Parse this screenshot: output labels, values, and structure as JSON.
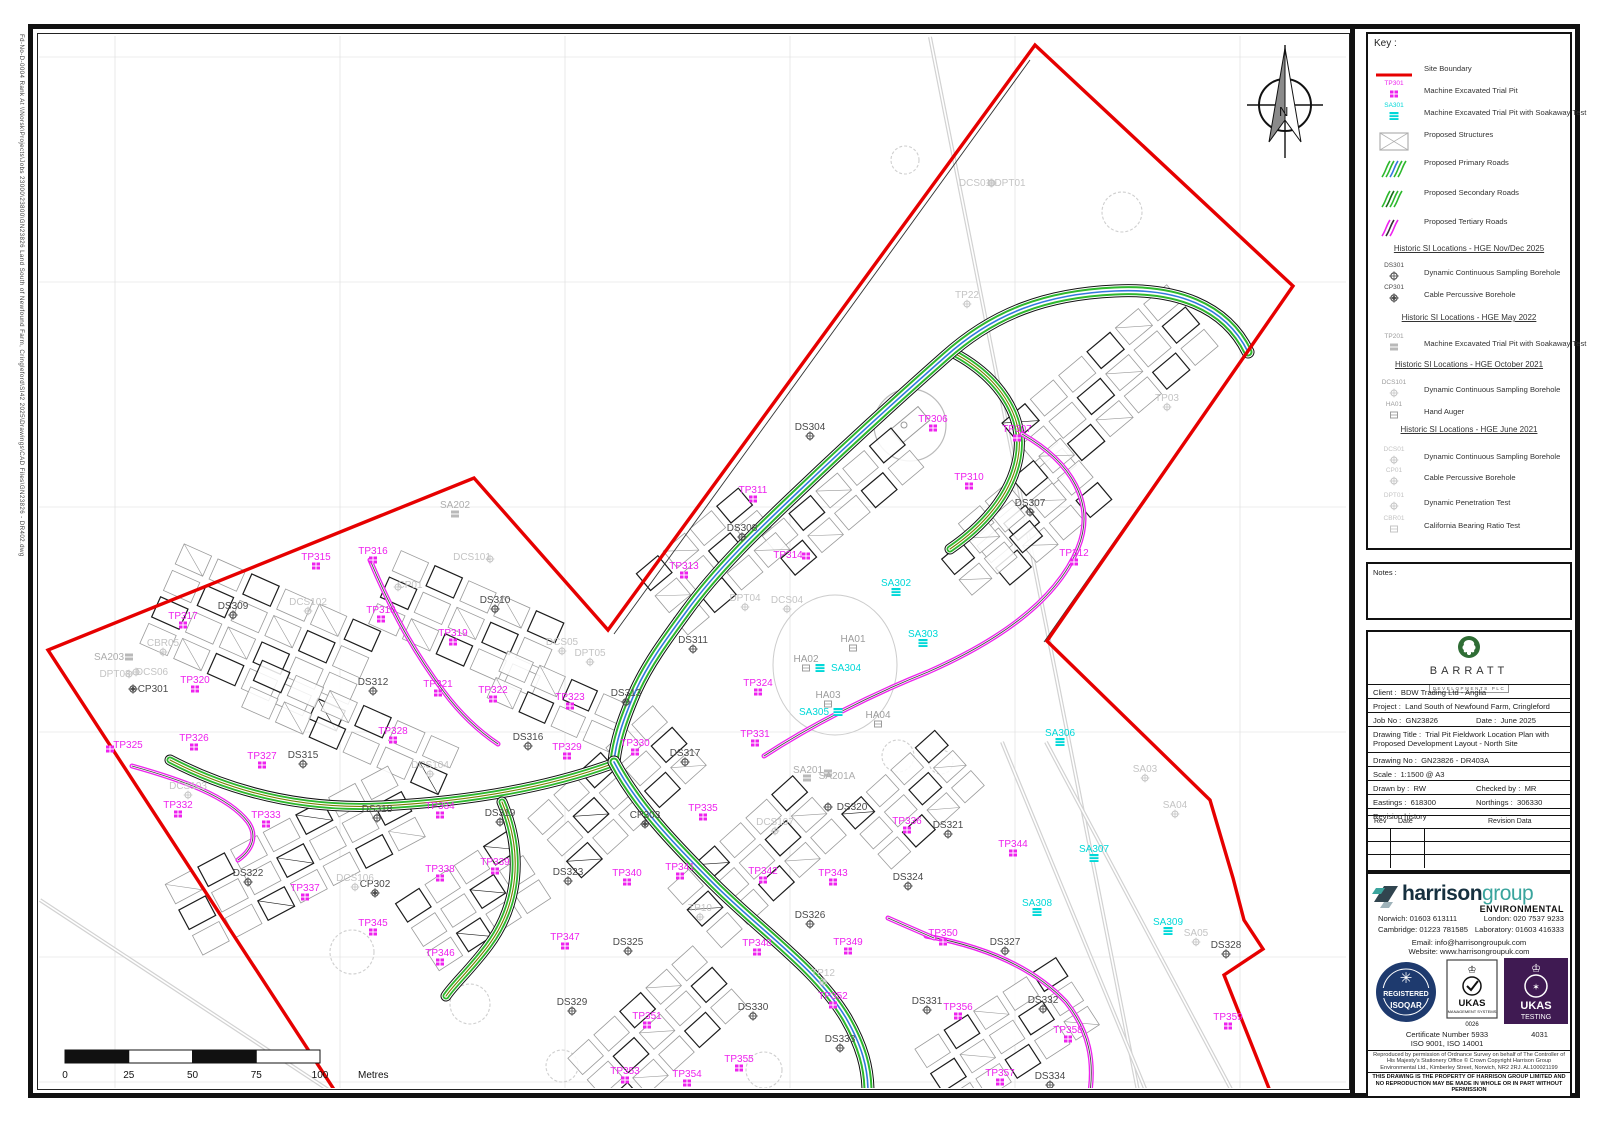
{
  "colors": {
    "red": "#e60000",
    "magenta": "#ee22ee",
    "cyan": "#00d8d8",
    "green": "#2db82d",
    "blue": "#3377dd",
    "olive": "#7a7a00",
    "dark": "#4a4a4a",
    "gray": "#9c9c9c",
    "lightgray": "#c4c4c4",
    "navy": "#1e3a6e",
    "purple": "#3f1a52",
    "barratt_green": "#2f6d35"
  },
  "edge_note": "Fd-No-D-0004  Rank At  \\\\Norsk\\Projects\\Jobs 23000\\23800\\GN23826  Land South of Newfound Farm, Cringleford\\SI42 2025\\Drawings\\CAD Files\\GN23826 - DR402.dwg",
  "north_label": "N",
  "key": {
    "title": "Key :",
    "items": [
      {
        "y": 27,
        "icon": "redline",
        "text": "Site Boundary"
      },
      {
        "y": 49,
        "icon": "tp",
        "code": "TP301",
        "text": "Machine Excavated Trial Pit"
      },
      {
        "y": 71,
        "icon": "sa",
        "code": "SA301",
        "text": "Machine Excavated Trial Pit with Soakaway Test"
      },
      {
        "y": 93,
        "icon": "struct",
        "text": "Proposed Structures"
      },
      {
        "y": 121,
        "icon": "prim",
        "text": "Proposed Primary Roads"
      },
      {
        "y": 151,
        "icon": "sec",
        "text": "Proposed Secondary Roads"
      },
      {
        "y": 180,
        "icon": "tert",
        "text": "Proposed Tertiary Roads"
      },
      {
        "y": 210,
        "header": "Historic SI Locations - HGE Nov/Dec 2025"
      },
      {
        "y": 231,
        "icon": "ds",
        "code": "DS301",
        "text": "Dynamic Continuous Sampling Borehole"
      },
      {
        "y": 253,
        "icon": "cp",
        "code": "CP301",
        "text": "Cable Percussive Borehole"
      },
      {
        "y": 279,
        "header": "Historic SI Locations - HGE May 2022"
      },
      {
        "y": 302,
        "icon": "gs",
        "code": "TP201",
        "text": "Machine Excavated Trial Pit with Soakaway Test"
      },
      {
        "y": 326,
        "header": "Historic SI Locations - HGE October 2021"
      },
      {
        "y": 348,
        "icon": "gh",
        "code": "DCS101",
        "text": "Dynamic Continuous Sampling Borehole"
      },
      {
        "y": 370,
        "icon": "ha",
        "code": "HA01",
        "text": "Hand Auger"
      },
      {
        "y": 391,
        "header": "Historic SI Locations - HGE June 2021"
      },
      {
        "y": 415,
        "icon": "lh",
        "code": "DCS01",
        "text": "Dynamic Continuous Sampling Borehole"
      },
      {
        "y": 436,
        "icon": "lh",
        "code": "CP01",
        "text": "Cable Percussive Borehole"
      },
      {
        "y": 461,
        "icon": "lh",
        "code": "DPT01",
        "text": "Dynamic Penetration Test"
      },
      {
        "y": 484,
        "icon": "lb",
        "code": "CBR01",
        "text": "California Bearing Ratio Test"
      }
    ]
  },
  "notes_label": "Notes :",
  "title_block": {
    "brand_name": "BARRATT",
    "brand_sub": "DEVELOPMENTS PLC",
    "client_label": "Client :",
    "client_value": "BDW Trading Ltd - Anglia",
    "project_label": "Project :",
    "project_value": "Land South of Newfound Farm, Cringleford",
    "job_label": "Job No :",
    "job_value": "GN23826",
    "date_label": "Date :",
    "date_value": "June 2025",
    "drawing_title_label": "Drawing Title :",
    "drawing_title_value": "Trial Pit Fieldwork Location Plan with Proposed Development Layout - North Site",
    "drawing_no_label": "Drawing No :",
    "drawing_no_value": "GN23826 - DR403A",
    "scale_label": "Scale :",
    "scale_value": "1:1500 @ A3",
    "drawn_label": "Drawn by :",
    "drawn_value": "RW",
    "checked_label": "Checked by :",
    "checked_value": "MR",
    "eastings_label": "Eastings :",
    "eastings_value": "618300",
    "northings_label": "Northings :",
    "northings_value": "306330",
    "revision_label": "Revision history",
    "rev_cols": [
      "Rev",
      "Date",
      "Revision Data"
    ]
  },
  "harrison": {
    "word1": "harrison",
    "word2": "group",
    "env": "ENVIRONMENTAL",
    "contact_norwich": "Norwich: 01603 613111",
    "contact_london": "London: 020 7537 9233",
    "contact_cambridge": "Cambridge: 01223 781585",
    "contact_lab": "Laboratory: 01603 416333",
    "email": "Email: info@harrisongroupuk.com",
    "website": "Website: www.harrisongroupuk.com",
    "badge_registered": "REGISTERED",
    "badge_isoqar": "ISOQAR",
    "badge_ukas1": "UKAS",
    "badge_mgmt": "MANAGEMENT SYSTEMS",
    "badge_0026": "0026",
    "badge_ukas2": "UKAS",
    "badge_testing": "TESTING",
    "cert1": "Certificate Number 5933",
    "cert2": "ISO 9001, ISO 14001",
    "testing_no": "4031",
    "os_copyright": "Reproduced by permission of Ordnance Survey on behalf of The Controller of His Majesty's Stationery Office © Crown Copyright Harrison Group Environmental Ltd., Kimberley Street, Norwich, NR2 2RJ. AL100021199",
    "property_note": "THIS DRAWING IS THE PROPERTY OF HARRISON GROUP LIMITED AND NO REPRODUCTION MAY BE MADE IN WHOLE OR IN PART WITHOUT PERMISSION"
  },
  "scalebar": {
    "ticks": [
      "0",
      "25",
      "50",
      "75",
      "100"
    ],
    "unit": "Metres",
    "x0": 65,
    "x1": 320,
    "y": 1050
  },
  "map": {
    "grid_x": [
      115,
      340,
      565,
      790,
      1015,
      1240
    ],
    "grid_y": [
      57,
      282,
      507,
      732,
      957,
      1082
    ],
    "boundary": "M 335,1091 L 48,650 L 474,478 L 608,630 L 1035,45 L 1293,286 L 1047,641 L 1210,800 L 1233,878 L 1244,920 L 1263,949 L 1224,975 L 1270,1091",
    "boundary_offsets": [
      "M 614,634 L 1030,60",
      "M 1286,296 L 1044,642"
    ],
    "footpaths": [
      "M 930,37 L 1138,1091",
      "M 1002,742 L 1146,1091",
      "M 1046,742 L 1232,1091",
      "M 40,900 L 330,1091"
    ],
    "primary_roads": [
      "M 1248,352 C 1225,305 1175,288 1115,291 C 1048,294 995,312 945,357 C 893,403 845,447 798,492 C 758,530 718,568 686,612 C 664,642 648,664 636,690 C 622,722 616,742 614,762",
      "M 614,762 C 636,804 672,842 714,884 C 762,932 816,968 846,1018 C 862,1046 868,1068 868,1092"
    ],
    "secondary_roads": [
      "M 952,352 C 998,376 1026,416 1018,458 C 1011,496 982,527 950,549",
      "M 612,764 C 540,790 460,802 380,806 C 290,810 220,786 170,760",
      "M 502,802 C 524,854 518,906 488,946 C 470,970 454,984 446,996"
    ],
    "tertiary_roads": [
      "M 370,560 C 392,612 414,652 444,692 C 462,716 480,732 498,744",
      "M 132,766 C 182,780 228,796 248,822 C 258,836 252,850 238,860",
      "M 1022,434 C 1072,462 1096,504 1078,548 C 1056,602 996,642 928,672 C 868,696 810,726 764,756",
      "M 926,936 C 982,946 1032,966 1066,1002 C 1090,1032 1094,1062 1090,1092",
      "M 888,918 C 906,926 920,932 934,938"
    ],
    "clusters": [
      [
        1115,
        385,
        6,
        3,
        30,
        22,
        -40
      ],
      [
        1040,
        512,
        4,
        3,
        28,
        22,
        -40
      ],
      [
        848,
        502,
        5,
        2,
        28,
        22,
        -40
      ],
      [
        718,
        562,
        4,
        3,
        28,
        22,
        -40
      ],
      [
        262,
        642,
        6,
        4,
        30,
        22,
        24
      ],
      [
        468,
        628,
        5,
        3,
        30,
        22,
        24
      ],
      [
        352,
        732,
        6,
        2,
        30,
        22,
        24
      ],
      [
        560,
        706,
        4,
        2,
        28,
        22,
        24
      ],
      [
        300,
        862,
        7,
        3,
        30,
        22,
        -28
      ],
      [
        478,
        902,
        4,
        3,
        28,
        22,
        -33
      ],
      [
        622,
        792,
        5,
        3,
        28,
        22,
        -42
      ],
      [
        762,
        862,
        5,
        3,
        28,
        22,
        -42
      ],
      [
        918,
        800,
        4,
        3,
        26,
        20,
        -42
      ],
      [
        662,
        1032,
        5,
        3,
        28,
        22,
        -42
      ],
      [
        1012,
        1038,
        5,
        3,
        28,
        22,
        -33
      ],
      [
        997,
        548,
        3,
        2,
        26,
        20,
        -40
      ]
    ],
    "trees": [
      [
        1122,
        212,
        20
      ],
      [
        905,
        160,
        14
      ],
      [
        352,
        952,
        22
      ],
      [
        470,
        1004,
        20
      ],
      [
        562,
        1066,
        16
      ],
      [
        764,
        1070,
        18
      ],
      [
        898,
        756,
        16
      ],
      [
        941,
        762,
        12
      ]
    ],
    "pond": [
      835,
      665,
      62,
      70
    ],
    "feature_circle": [
      910,
      425,
      36
    ],
    "markers": [
      [
        "TP306",
        933,
        419,
        "tp"
      ],
      [
        "TP307",
        1017,
        429,
        "tp"
      ],
      [
        "TP310",
        969,
        477,
        "tp"
      ],
      [
        "TP311",
        753,
        490,
        "tp"
      ],
      [
        "TP312",
        1074,
        553,
        "tp"
      ],
      [
        "TP313",
        684,
        566,
        "tp"
      ],
      [
        "TP314",
        788,
        555,
        "tp",
        18,
        1
      ],
      [
        "TP315",
        316,
        557,
        "tp"
      ],
      [
        "TP316",
        373,
        551,
        "tp"
      ],
      [
        "TP317",
        183,
        616,
        "tp"
      ],
      [
        "TP318",
        381,
        610,
        "tp"
      ],
      [
        "TP319",
        453,
        633,
        "tp"
      ],
      [
        "TP320",
        195,
        680,
        "tp"
      ],
      [
        "TP321",
        438,
        684,
        "tp"
      ],
      [
        "TP322",
        493,
        690,
        "tp"
      ],
      [
        "TP323",
        570,
        697,
        "tp"
      ],
      [
        "TP324",
        758,
        683,
        "tp"
      ],
      [
        "TP325",
        128,
        745,
        "tp",
        -18,
        4
      ],
      [
        "TP326",
        194,
        738,
        "tp"
      ],
      [
        "TP327",
        262,
        756,
        "tp"
      ],
      [
        "TP328",
        393,
        731,
        "tp"
      ],
      [
        "TP329",
        567,
        747,
        "tp"
      ],
      [
        "TP330",
        635,
        743,
        "tp"
      ],
      [
        "TP331",
        755,
        734,
        "tp"
      ],
      [
        "TP332",
        178,
        805,
        "tp"
      ],
      [
        "TP333",
        266,
        815,
        "tp"
      ],
      [
        "TP334",
        440,
        806,
        "tp"
      ],
      [
        "TP335",
        703,
        808,
        "tp"
      ],
      [
        "TP336",
        907,
        821,
        "tp"
      ],
      [
        "TP337",
        305,
        888,
        "tp"
      ],
      [
        "TP338",
        440,
        869,
        "tp"
      ],
      [
        "TP339",
        495,
        862,
        "tp"
      ],
      [
        "TP340",
        627,
        873,
        "tp"
      ],
      [
        "TP341",
        680,
        867,
        "tp"
      ],
      [
        "TP342",
        763,
        871,
        "tp"
      ],
      [
        "TP343",
        833,
        873,
        "tp"
      ],
      [
        "TP344",
        1013,
        844,
        "tp"
      ],
      [
        "TP345",
        373,
        923,
        "tp"
      ],
      [
        "TP346",
        440,
        953,
        "tp"
      ],
      [
        "TP347",
        565,
        937,
        "tp"
      ],
      [
        "TP348",
        757,
        943,
        "tp"
      ],
      [
        "TP349",
        848,
        942,
        "tp"
      ],
      [
        "TP350",
        943,
        933,
        "tp"
      ],
      [
        "TP351",
        647,
        1016,
        "tp"
      ],
      [
        "TP352",
        833,
        996,
        "tp"
      ],
      [
        "TP353",
        625,
        1071,
        "tp"
      ],
      [
        "TP354",
        687,
        1074,
        "tp"
      ],
      [
        "TP355",
        739,
        1059,
        "tp"
      ],
      [
        "TP356",
        958,
        1007,
        "tp"
      ],
      [
        "TP357",
        1000,
        1073,
        "tp"
      ],
      [
        "TP358",
        1068,
        1030,
        "tp"
      ],
      [
        "TP359",
        1228,
        1017,
        "tp"
      ],
      [
        "SA302",
        896,
        583,
        "sa"
      ],
      [
        "SA303",
        923,
        634,
        "sa"
      ],
      [
        "SA304",
        846,
        668,
        "sa",
        -26,
        0
      ],
      [
        "SA305",
        814,
        712,
        "sa",
        24,
        0
      ],
      [
        "SA306",
        1060,
        733,
        "sa"
      ],
      [
        "SA307",
        1094,
        849,
        "sa"
      ],
      [
        "SA308",
        1037,
        903,
        "sa"
      ],
      [
        "SA309",
        1168,
        922,
        "sa"
      ],
      [
        "DS304",
        810,
        427,
        "ds"
      ],
      [
        "DS307",
        1030,
        503,
        "ds"
      ],
      [
        "DS308",
        742,
        528,
        "ds"
      ],
      [
        "DS309",
        233,
        606,
        "ds"
      ],
      [
        "DS310",
        495,
        600,
        "ds"
      ],
      [
        "DS311",
        693,
        640,
        "ds"
      ],
      [
        "DS312",
        373,
        682,
        "ds"
      ],
      [
        "DS313",
        626,
        693,
        "ds"
      ],
      [
        "DS315",
        303,
        755,
        "ds"
      ],
      [
        "DS316",
        528,
        737,
        "ds"
      ],
      [
        "DS317",
        685,
        753,
        "ds"
      ],
      [
        "DS318",
        377,
        809,
        "ds"
      ],
      [
        "DS319",
        500,
        813,
        "ds"
      ],
      [
        "DS320",
        852,
        807,
        "ds",
        -24,
        0
      ],
      [
        "DS321",
        948,
        825,
        "ds"
      ],
      [
        "DS322",
        248,
        873,
        "ds"
      ],
      [
        "DS323",
        568,
        872,
        "ds"
      ],
      [
        "DS324",
        908,
        877,
        "ds"
      ],
      [
        "DS325",
        628,
        942,
        "ds"
      ],
      [
        "DS326",
        810,
        915,
        "ds"
      ],
      [
        "DS327",
        1005,
        942,
        "ds"
      ],
      [
        "DS328",
        1226,
        945,
        "ds"
      ],
      [
        "DS329",
        572,
        1002,
        "ds"
      ],
      [
        "DS330",
        753,
        1007,
        "ds"
      ],
      [
        "DS331",
        927,
        1001,
        "ds"
      ],
      [
        "DS332",
        1043,
        1000,
        "ds"
      ],
      [
        "DS333",
        840,
        1039,
        "ds"
      ],
      [
        "DS334",
        1050,
        1076,
        "ds"
      ],
      [
        "CP301",
        153,
        689,
        "cp",
        -20,
        0
      ],
      [
        "CP302",
        375,
        884,
        "cp"
      ],
      [
        "CP303",
        645,
        815,
        "cp"
      ],
      [
        "HA01",
        853,
        639,
        "ha"
      ],
      [
        "HA02",
        806,
        659,
        "ha"
      ],
      [
        "HA03",
        828,
        695,
        "ha"
      ],
      [
        "HA04",
        878,
        715,
        "ha"
      ],
      [
        "SA203",
        109,
        657,
        "gs",
        20,
        0
      ],
      [
        "SA202",
        455,
        505,
        "gs"
      ],
      [
        "SA201",
        808,
        770,
        "gs",
        20,
        3
      ],
      [
        "SA201A",
        837,
        776,
        "gs",
        -30,
        2
      ],
      [
        "DCS101",
        472,
        557,
        "gh",
        18,
        2
      ],
      [
        "CP01",
        410,
        585,
        "gh",
        -12,
        2
      ],
      [
        "DCS102",
        308,
        602,
        "gh"
      ],
      [
        "CBR05",
        163,
        643,
        "gh"
      ],
      [
        "DPT03",
        115,
        674,
        "gh",
        14,
        0
      ],
      [
        "DCS06",
        152,
        672,
        "gh",
        -16,
        0
      ],
      [
        "DCS103",
        188,
        786,
        "gh"
      ],
      [
        "DCS104",
        430,
        765,
        "gh"
      ],
      [
        "DCS106",
        355,
        878,
        "gh"
      ],
      [
        "DCS05",
        562,
        642,
        "gh"
      ],
      [
        "DPT05",
        590,
        653,
        "gh"
      ],
      [
        "DCS01",
        975,
        183,
        "gh",
        16,
        0
      ],
      [
        "DPT01",
        1010,
        183,
        "gh",
        -18,
        0
      ],
      [
        "TP22",
        967,
        295,
        "gh"
      ],
      [
        "TP03",
        1167,
        398,
        "gh"
      ],
      [
        "TP10",
        700,
        908,
        "gh"
      ],
      [
        "TP12",
        823,
        973,
        "gh"
      ],
      [
        "DCS107",
        775,
        822,
        "gh"
      ],
      [
        "DPT04",
        745,
        598,
        "gh"
      ],
      [
        "DCS04",
        787,
        600,
        "gh"
      ],
      [
        "SA03",
        1145,
        769,
        "gh"
      ],
      [
        "SA04",
        1175,
        805,
        "gh"
      ],
      [
        "SA05",
        1196,
        933,
        "gh"
      ]
    ]
  }
}
